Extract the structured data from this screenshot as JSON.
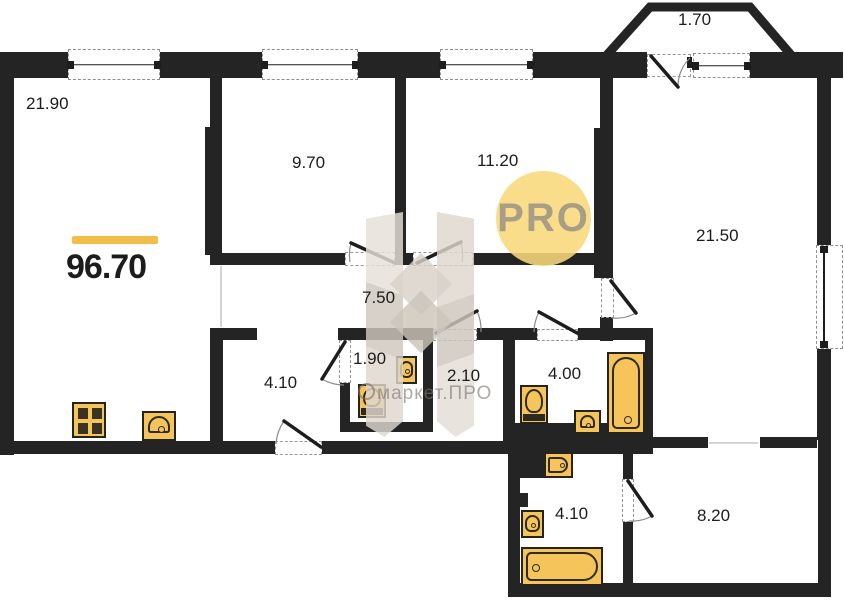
{
  "plan": {
    "title": "apartment floor plan",
    "total_area": "96.70",
    "logo_text": "PRO",
    "watermark_text": "маркет.ПРО",
    "accent_color": "#f2bd4a",
    "wall_color": "#242424",
    "fixture_color": "#f5c45a",
    "rooms": [
      {
        "id": "living-room",
        "area": "21.90"
      },
      {
        "id": "bedroom-1",
        "area": "9.70"
      },
      {
        "id": "bedroom-2",
        "area": "11.20"
      },
      {
        "id": "balcony",
        "area": "1.70"
      },
      {
        "id": "living-room-2",
        "area": "21.50"
      },
      {
        "id": "corridor",
        "area": "7.50"
      },
      {
        "id": "entrance-hall",
        "area": "4.10"
      },
      {
        "id": "wc",
        "area": "1.90"
      },
      {
        "id": "storage",
        "area": "2.10"
      },
      {
        "id": "bathroom",
        "area": "4.00"
      },
      {
        "id": "bathroom-2",
        "area": "4.10"
      },
      {
        "id": "hallway-2",
        "area": "8.20"
      }
    ]
  }
}
